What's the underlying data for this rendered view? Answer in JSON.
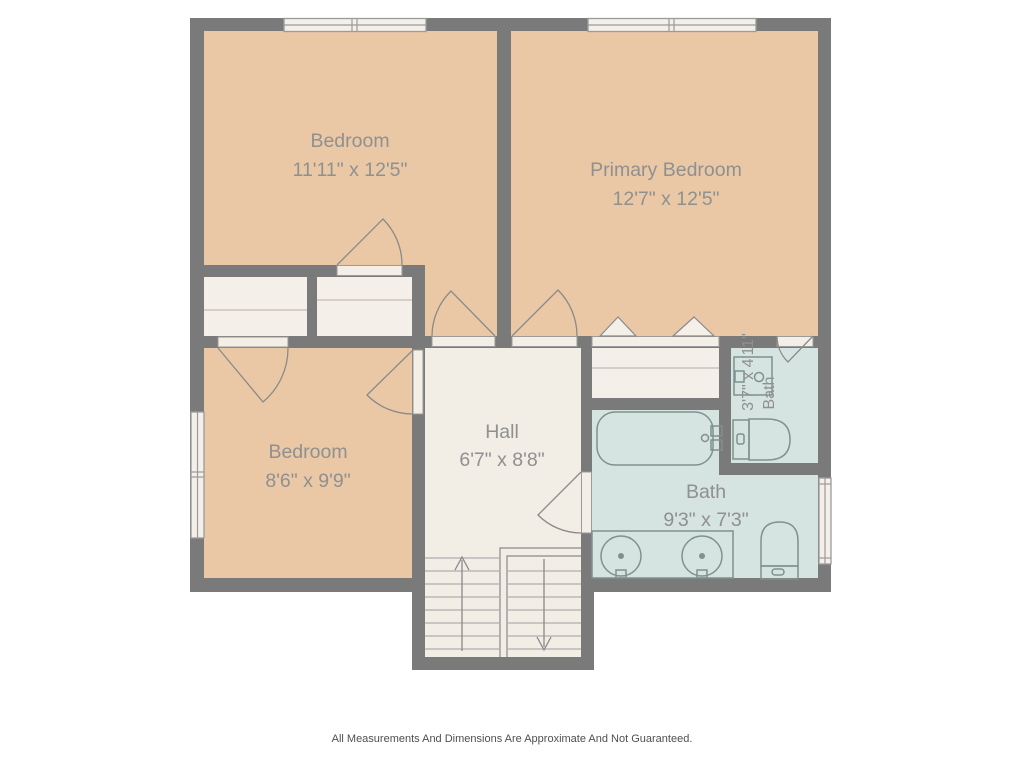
{
  "rooms": {
    "bedroom_top_left": {
      "name": "Bedroom",
      "dims": "11'11\" x 12'5\""
    },
    "primary_bedroom": {
      "name": "Primary Bedroom",
      "dims": "12'7\" x 12'5\""
    },
    "bedroom_bottom_left": {
      "name": "Bedroom",
      "dims": "8'6\" x 9'9\""
    },
    "hall": {
      "name": "Hall",
      "dims": "6'7\" x 8'8\""
    },
    "bath_small": {
      "name": "Bath",
      "dims": "3'7\" x 4'11\""
    },
    "bath_large": {
      "name": "Bath",
      "dims": "9'3\" x 7'3\""
    }
  },
  "footer": {
    "disclaimer": "All Measurements And Dimensions Are Approximate And Not Guaranteed."
  },
  "colors": {
    "wall": "#7a7a7a",
    "bedroom_floor": "#eac8a6",
    "hall_floor": "#f2ede5",
    "bath_floor": "#d5e4e1",
    "closet_floor": "#f4efe8",
    "door_leaf": "#f3eee6",
    "outline": "#8a8a8a",
    "fixture_line": "#7f918e",
    "window_line": "#9b9b9b",
    "shelf_line": "#c9c3ba",
    "tread_line": "#9e9e9e",
    "label_text": "#8f9090",
    "footer_text": "#4f4f4f",
    "background": "#ffffff"
  }
}
